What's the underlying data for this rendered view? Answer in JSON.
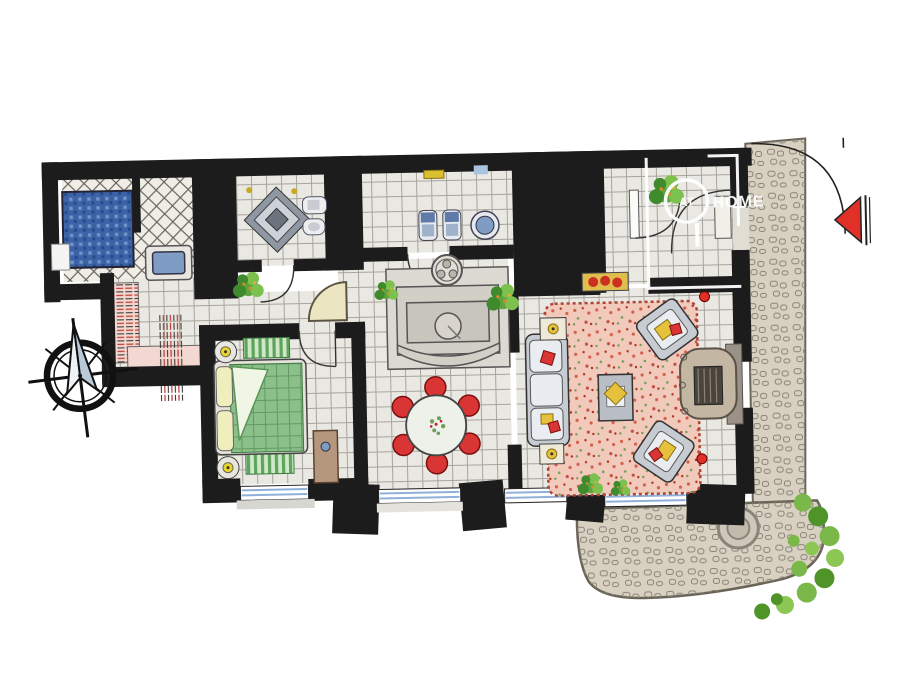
{
  "watermark": {
    "prefix": "AT",
    "name": "HOME"
  },
  "icons": {
    "compass": "compass-rose-icon",
    "entrance_marker": "entrance-arrow-icon"
  },
  "colors": {
    "wall": "#1c1c1c",
    "floor": "#eae8e2",
    "floor_line": "#a6a49c",
    "shower_blue": "#3c63a8",
    "mosaic_light": "#7e9cc8",
    "tub_blue": "#7f9cc4",
    "quilt_green": "#8cc08a",
    "quilt_line": "#3e7a42",
    "pillow_yellow": "#f0eebc",
    "lamp_yellow": "#e8d42a",
    "rug_pink": "#f2cabc",
    "speckle_red": "#d4604c",
    "speckle_green": "#6f9e58",
    "chair_red": "#d93535",
    "accent_yellow": "#e6c23c",
    "sofa_gray": "#c6ccd2",
    "cushion_white": "#e9ecf1",
    "fireplace_tan": "#c3b6a2",
    "wood_tan": "#b5977e",
    "stone_tan": "#d8d1c2",
    "stone_line": "#8a8478",
    "plant_green": "#5da43e",
    "bush_green": "#7ab84a",
    "marker_red": "#e03028",
    "glass_blue": "#8fb0d8",
    "stair_pink": "#f2d8d0",
    "stair_red": "#c04038"
  }
}
